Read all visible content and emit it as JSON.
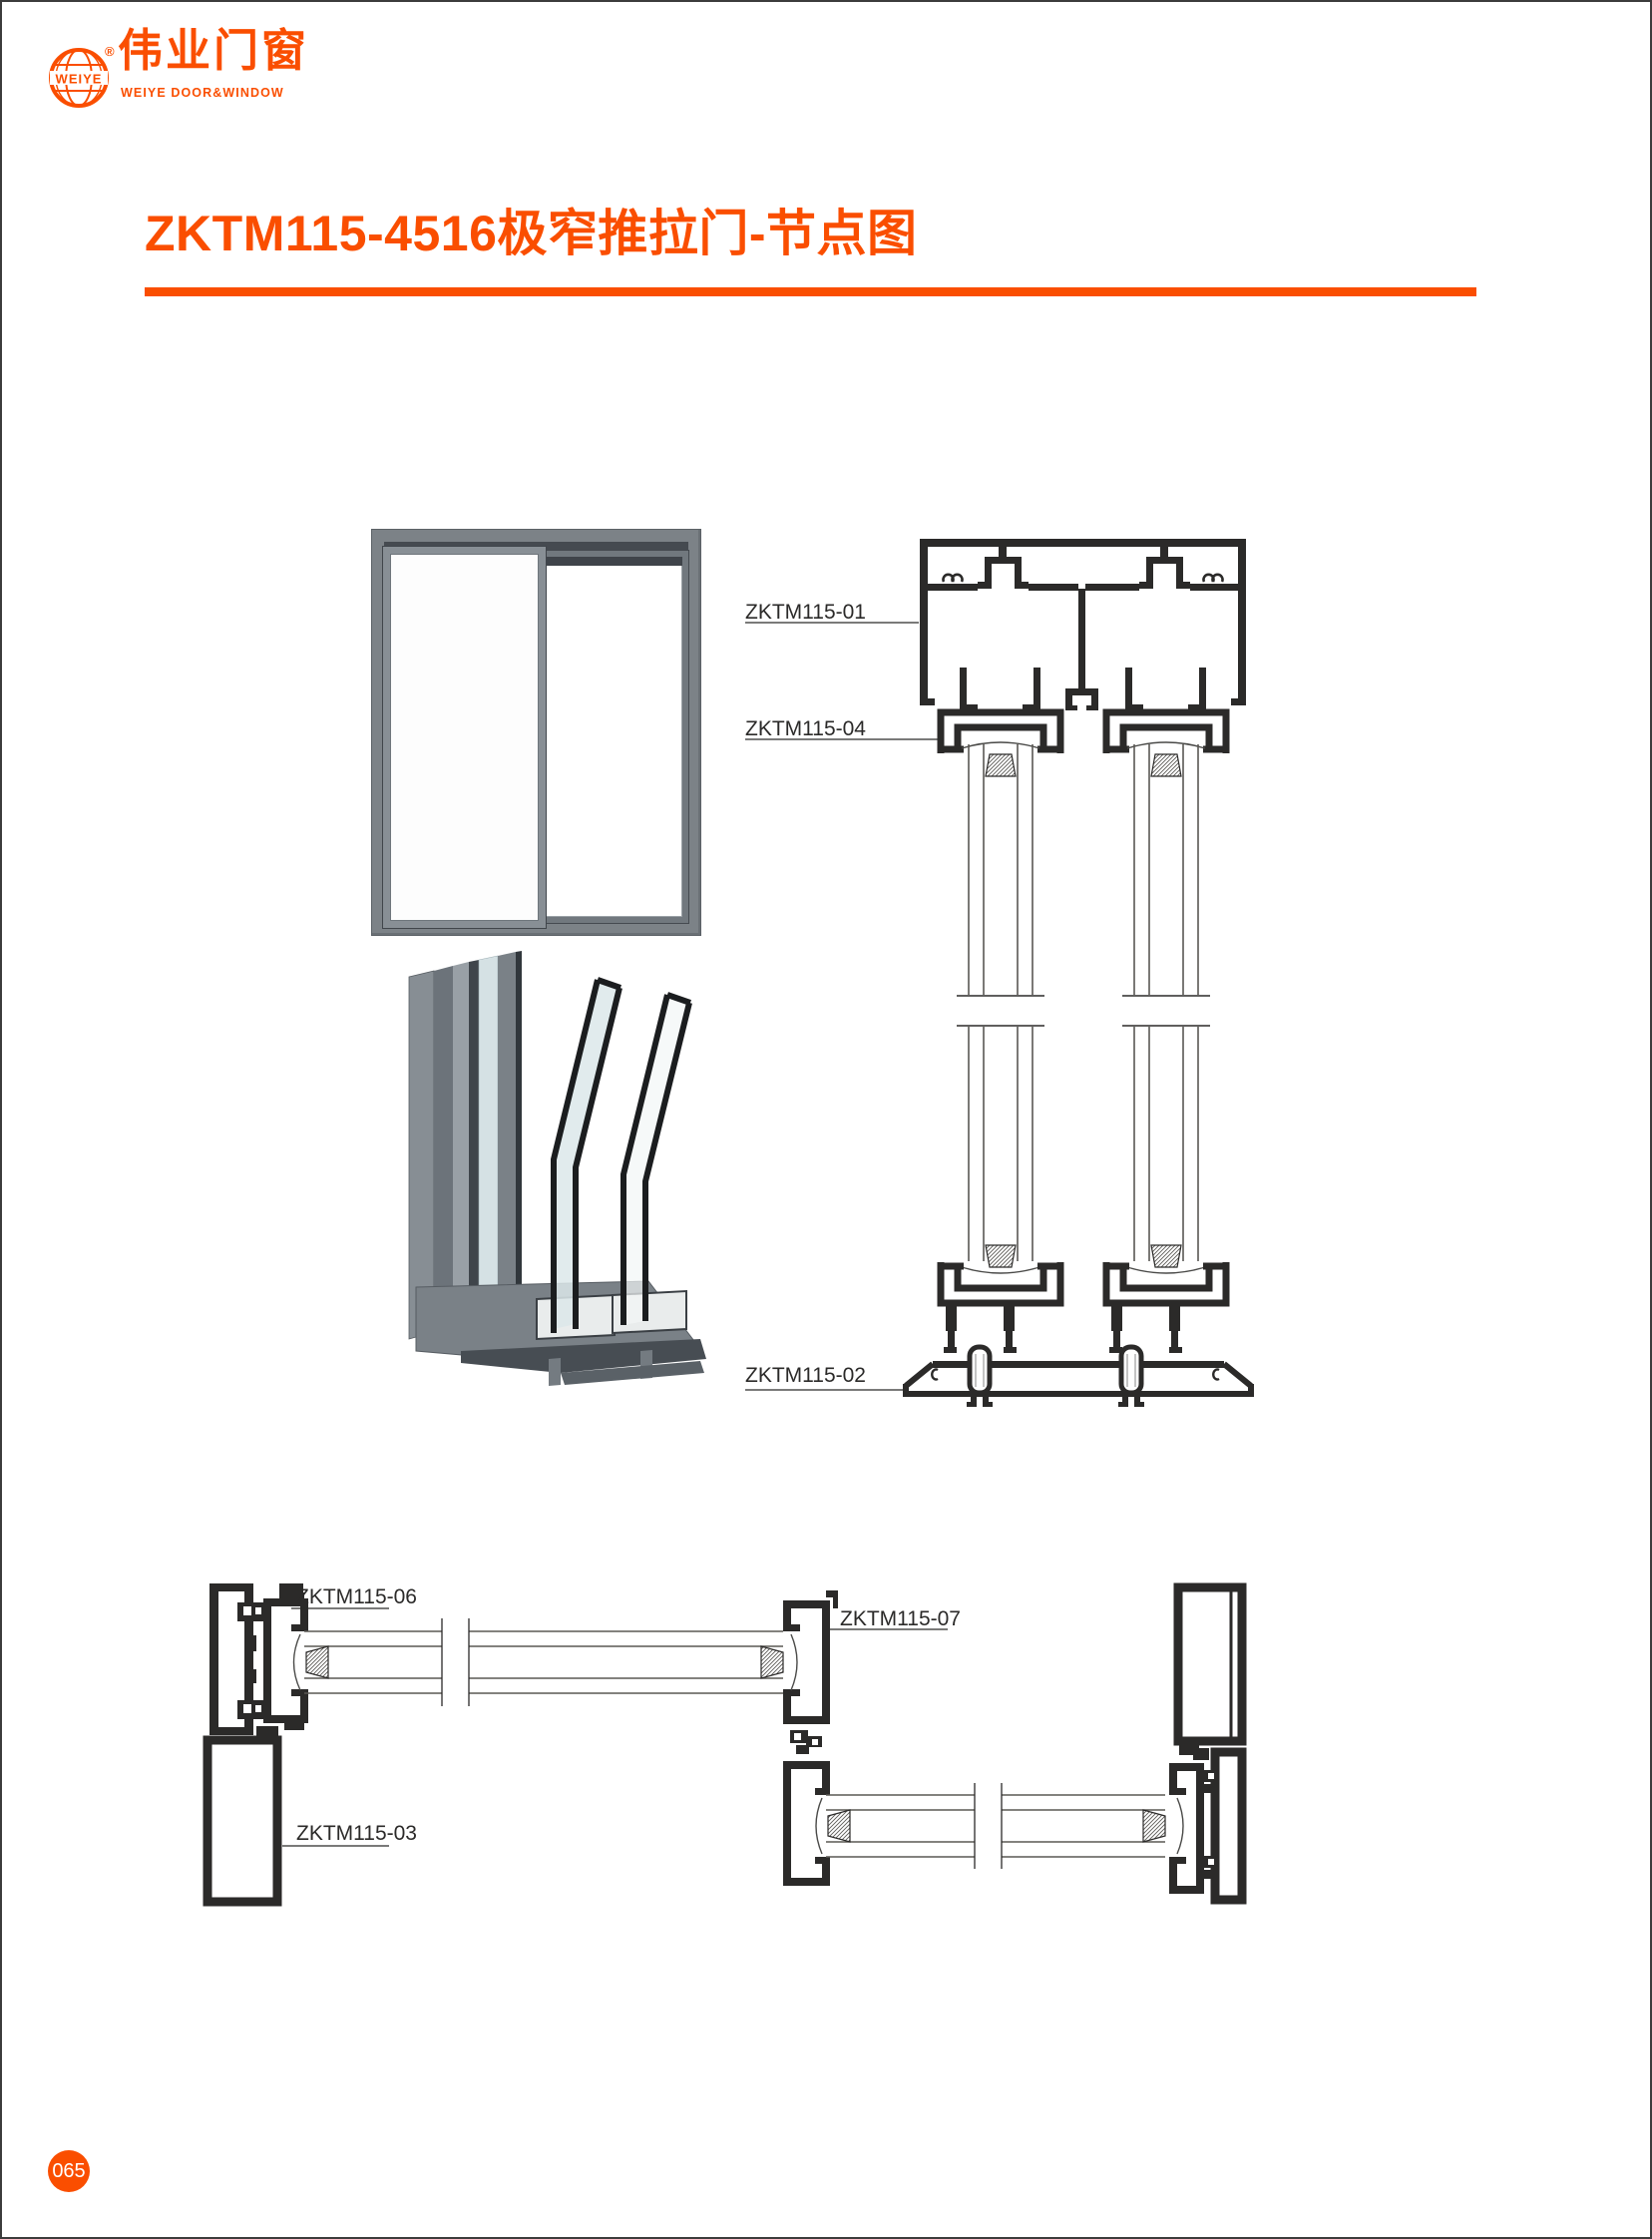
{
  "brand": {
    "globe_text": "WEIYE",
    "registered": "®",
    "name_cn": "伟业门窗",
    "name_en": "WEIYE DOOR&WINDOW"
  },
  "page": {
    "title": "ZKTM115-4516极窄推拉门-节点图",
    "number": "065"
  },
  "figures": {
    "vertical_section": {
      "labels": {
        "l01": "ZKTM115-01",
        "l04": "ZKTM115-04",
        "l02": "ZKTM115-02"
      }
    },
    "plan_section": {
      "labels": {
        "l06": "ZKTM115-06",
        "l07": "ZKTM115-07",
        "l03": "ZKTM115-03"
      }
    }
  },
  "colors": {
    "accent": "#FA4E00",
    "line": "#2B2A29",
    "frame_gray": "#7C8287"
  }
}
